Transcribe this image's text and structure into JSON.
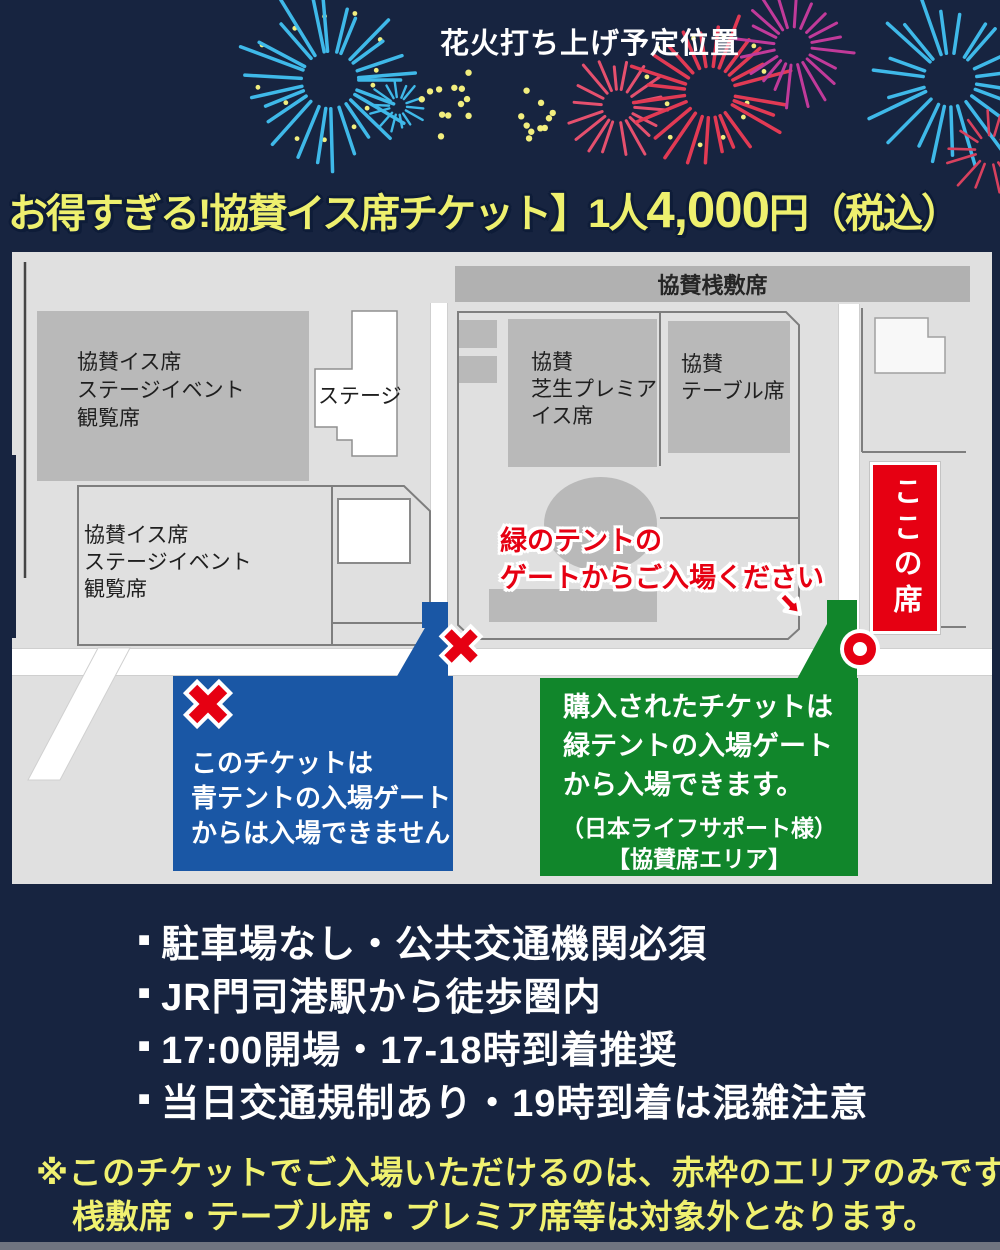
{
  "colors": {
    "background": "#172440",
    "headline_yellow": "#eef06e",
    "map_gray": "#e0e0e0",
    "block_gray": "#b9b9b9",
    "red": "#e60012",
    "blue": "#1a57a5",
    "green": "#11862b",
    "warning_yellow": "#f0f170",
    "fireworks": [
      "#3fb9e9",
      "#e23a54",
      "#c13a9a",
      "#f2ee7e"
    ]
  },
  "header": {
    "fireworks_label": "花火打ち上げ予定位置",
    "headline_prefix": "お得すぎる!協賛イス席チケット】1人",
    "headline_price": "4,000",
    "headline_suffix": "円（税込）"
  },
  "map": {
    "top_bar_label": "協賛桟敷席",
    "upper_left_block": "協賛イス席\nステージイベント\n観覧席",
    "lower_left_block": "協賛イス席\nステージイベント\n観覧席",
    "stage_label": "ステージ",
    "lawn_premium_block": "協賛\n芝生プレミア\nイス席",
    "table_block": "協賛\nテーブル席",
    "here_seat": "ここの席",
    "green_gate_instruction": "緑のテントの\nゲートからご入場ください"
  },
  "blue_callout": {
    "text": "このチケットは\n青テントの入場ゲート\nからは入場できません"
  },
  "green_callout": {
    "text": "購入されたチケットは\n緑テントの入場ゲート\nから入場できます。",
    "note1": "（日本ライフサポート様）",
    "note2": "【協賛席エリア】"
  },
  "notes": {
    "bullet": "■",
    "items": [
      "駐車場なし・公共交通機関必須",
      "JR門司港駅から徒歩圏内",
      "17:00開場・17-18時到着推奨",
      "当日交通規制あり・19時到着は混雑注意"
    ]
  },
  "warning": {
    "line1": "※このチケットでご入場いただけるのは、赤枠のエリアのみです。",
    "line2": "桟敷席・テーブル席・プレミア席等は対象外となります。"
  }
}
